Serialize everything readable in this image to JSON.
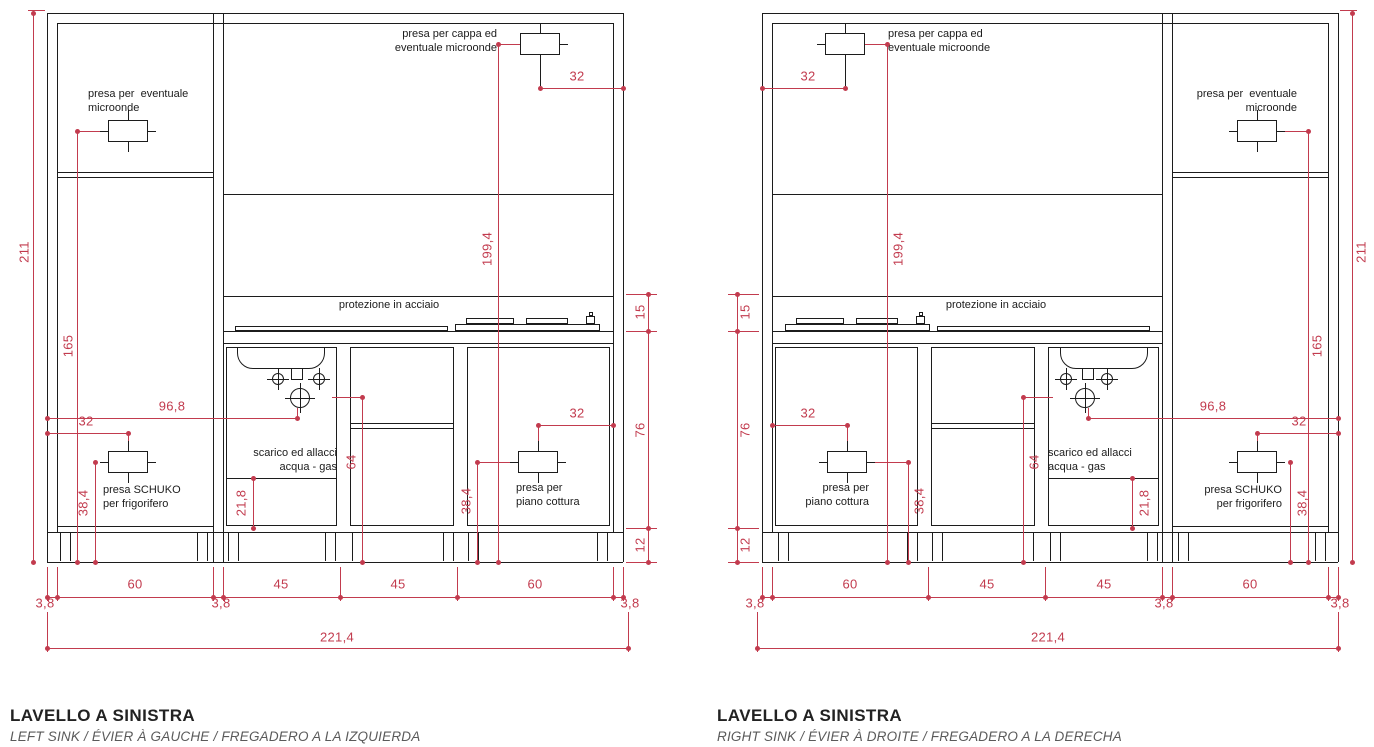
{
  "colors": {
    "background": "#ffffff",
    "line": "#1c1c1c",
    "dimension": "#c23b4e",
    "title": "#222222",
    "subtitle": "#5a5a5a"
  },
  "labels": {
    "microwave_outlet_l1": "presa per  eventuale",
    "microwave_outlet_l2": "microonde",
    "hood_outlet_l1": "presa per cappa ed",
    "hood_outlet_l2": "eventuale microonde",
    "steel_protection": "protezione in acciaio",
    "drain_l1": "scarico ed allacci",
    "drain_l2": "acqua - gas",
    "schuko_l1": "presa SCHUKO",
    "schuko_l2": "per frigorifero",
    "cooktop_outlet_l1": "presa per",
    "cooktop_outlet_l2": "piano cottura"
  },
  "dims": {
    "total_height": "211",
    "microwave_height": "165",
    "sink_center_offset": "96,8",
    "schuko_wall_offset": "32",
    "schuko_height": "38,4",
    "drain_shelf_height": "21,8",
    "gas_point_height": "64",
    "hood_outlet_height": "199,4",
    "hood_outlet_offset": "32",
    "cooktop_outlet_offset": "32",
    "cooktop_outlet_height": "38,4",
    "protection_height": "15",
    "base_height": "76",
    "plinth_height": "12",
    "panel_widths": [
      "3,8",
      "60",
      "3,8",
      "45",
      "45",
      "60",
      "3,8"
    ],
    "total_width": "221,4"
  },
  "drawings": [
    {
      "id": "left",
      "title": "LAVELLO A SINISTRA",
      "subtitle": "LEFT SINK / ÉVIER À GAUCHE / FREGADERO A LA IZQUIERDA"
    },
    {
      "id": "right",
      "title": "LAVELLO A SINISTRA",
      "subtitle": "RIGHT SINK / ÉVIER À DROITE / FREGADERO A LA DERECHA"
    }
  ]
}
